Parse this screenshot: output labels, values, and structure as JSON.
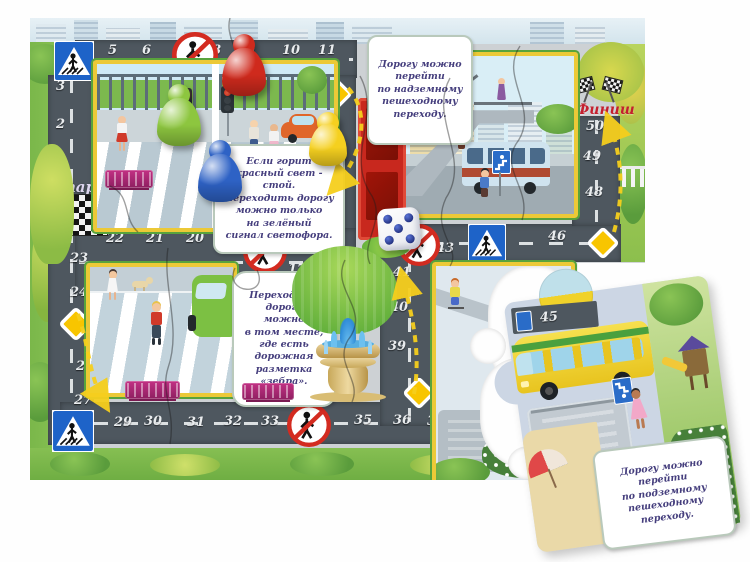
{
  "labels": {
    "start": "Старт",
    "finish": "Финиш"
  },
  "track": {
    "top_row": [
      "5",
      "6",
      "8",
      "9",
      "10",
      "11"
    ],
    "left_col_upper": [
      "3",
      "2",
      "1"
    ],
    "mid_col": [
      "14",
      "15",
      "16"
    ],
    "mid_row_upper": [
      "22",
      "21",
      "20"
    ],
    "mid_row_lower": [
      "19",
      "17"
    ],
    "left_col_lower": [
      "23",
      "24",
      "26",
      "27"
    ],
    "bottom_row": [
      "29",
      "30",
      "31",
      "32",
      "33",
      "35",
      "36",
      "37"
    ],
    "right_col_mid": [
      "41",
      "40",
      "39"
    ],
    "top_right_row": [
      "43",
      "46"
    ],
    "right_col_top": [
      "50",
      "49",
      "48"
    ],
    "loose_piece_cell": "45"
  },
  "cards": {
    "overpass": "Дорогу можно\nперейти\nпо надземному\nпешеходному\nпереходу.",
    "traffic_light": "Если горит\nкрасный свет - стой.\nПереходить дорогу\nможно только\nна зелёный\nсигнал светофора.",
    "zebra": "Переходить\nдорогу\nможно\nв том месте,\nгде есть\nдорожная\nразметка\n«зебра».",
    "underpass": "Дорогу можно\nперейти\nпо подземному\nпешеходному\nпереходу."
  },
  "pieces": {
    "pawns": [
      {
        "name": "red-pawn",
        "color": "#cf2a1d"
      },
      {
        "name": "green-pawn",
        "color": "#8dc63f"
      },
      {
        "name": "blue-pawn",
        "color": "#2e62c5"
      },
      {
        "name": "yellow-pawn",
        "color": "#f5d01f"
      }
    ],
    "die": {
      "visible_value": 5,
      "pip_color": "#22307e",
      "body_color": "#ffffff"
    }
  },
  "signs": {
    "no_pedestrian": "no-pedestrian-crossing-sign",
    "pedestrian_crossing": "pedestrian-crossing-sign",
    "priority_road": "priority-road-sign"
  }
}
